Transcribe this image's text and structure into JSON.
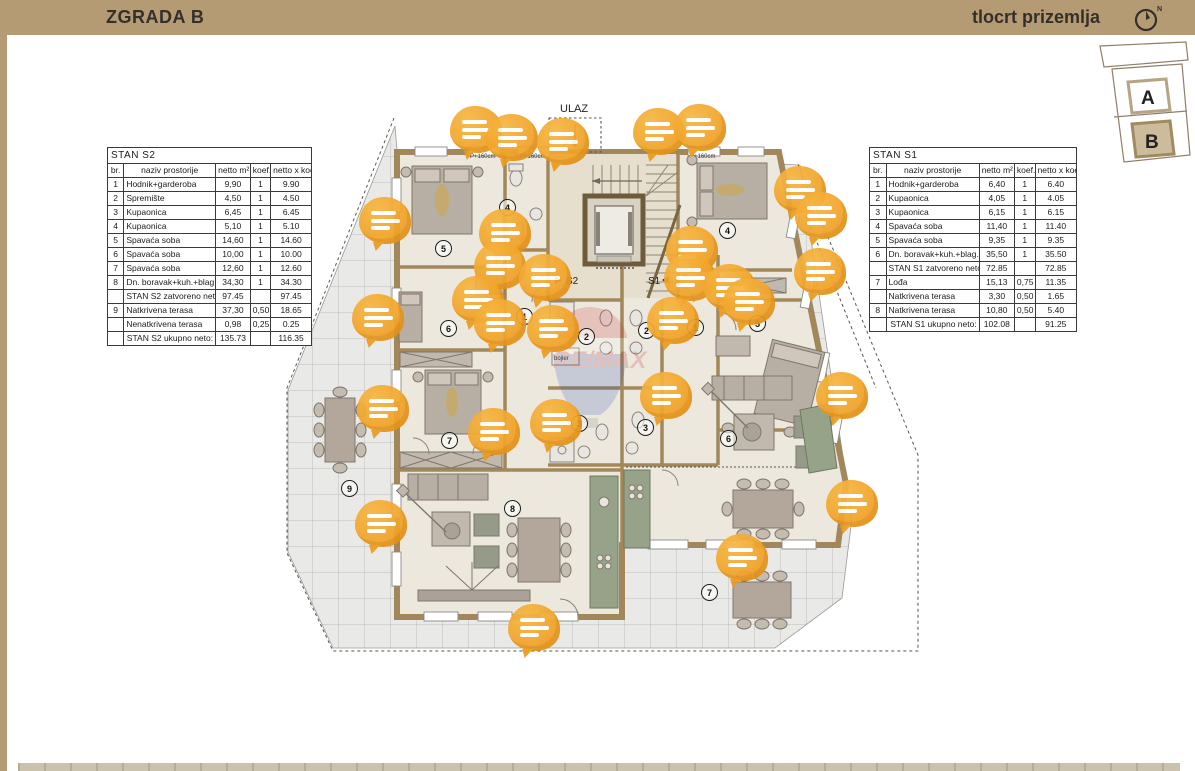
{
  "header": {
    "title_left": "ZGRADA B",
    "title_right": "tlocrt prizemlja",
    "north_label": "N",
    "bar_color": "#b59b74"
  },
  "site_diagram": {
    "building_a": "A",
    "building_b": "B"
  },
  "plan": {
    "entrance_label": "ULAZ",
    "door_label_left": "S2",
    "door_label_right": "S1",
    "boiler_label": "bojler",
    "watermark": "RE/MAX",
    "window_labels": [
      "P+160cm",
      "P+160cm",
      "P+160cm"
    ],
    "marker_color": "#f2a52b",
    "room_circles": [
      {
        "n": "5",
        "x": 443,
        "y": 248
      },
      {
        "n": "6",
        "x": 448,
        "y": 328
      },
      {
        "n": "7",
        "x": 449,
        "y": 440
      },
      {
        "n": "4",
        "x": 507,
        "y": 207
      },
      {
        "n": "1",
        "x": 524,
        "y": 316
      },
      {
        "n": "2",
        "x": 586,
        "y": 336
      },
      {
        "n": "3",
        "x": 579,
        "y": 423
      },
      {
        "n": "8",
        "x": 512,
        "y": 508
      },
      {
        "n": "9",
        "x": 349,
        "y": 488
      },
      {
        "n": "4",
        "x": 727,
        "y": 230
      },
      {
        "n": "5",
        "x": 757,
        "y": 323
      },
      {
        "n": "1",
        "x": 695,
        "y": 327
      },
      {
        "n": "2",
        "x": 646,
        "y": 330
      },
      {
        "n": "3",
        "x": 645,
        "y": 427
      },
      {
        "n": "6",
        "x": 728,
        "y": 438
      },
      {
        "n": "7",
        "x": 709,
        "y": 592
      }
    ],
    "markers": [
      {
        "x": 476,
        "y": 131
      },
      {
        "x": 512,
        "y": 139
      },
      {
        "x": 563,
        "y": 143
      },
      {
        "x": 659,
        "y": 133
      },
      {
        "x": 700,
        "y": 129
      },
      {
        "x": 800,
        "y": 191
      },
      {
        "x": 821,
        "y": 217
      },
      {
        "x": 385,
        "y": 222
      },
      {
        "x": 505,
        "y": 234
      },
      {
        "x": 500,
        "y": 267
      },
      {
        "x": 545,
        "y": 279
      },
      {
        "x": 478,
        "y": 301
      },
      {
        "x": 692,
        "y": 251
      },
      {
        "x": 690,
        "y": 279
      },
      {
        "x": 730,
        "y": 289
      },
      {
        "x": 749,
        "y": 303
      },
      {
        "x": 820,
        "y": 273
      },
      {
        "x": 378,
        "y": 319
      },
      {
        "x": 500,
        "y": 324
      },
      {
        "x": 553,
        "y": 330
      },
      {
        "x": 673,
        "y": 322
      },
      {
        "x": 383,
        "y": 410
      },
      {
        "x": 494,
        "y": 433
      },
      {
        "x": 556,
        "y": 424
      },
      {
        "x": 666,
        "y": 397
      },
      {
        "x": 842,
        "y": 397
      },
      {
        "x": 381,
        "y": 525
      },
      {
        "x": 852,
        "y": 505
      },
      {
        "x": 742,
        "y": 559
      },
      {
        "x": 534,
        "y": 629
      }
    ]
  },
  "tables": {
    "s2": {
      "title": "STAN S2",
      "columns": [
        "br.",
        "naziv prostorije",
        "netto m²",
        "koef.",
        "netto x koef. m²"
      ],
      "rows": [
        [
          "1",
          "Hodnik+garderoba",
          "9,90",
          "1",
          "9.90"
        ],
        [
          "2",
          "Spremište",
          "4,50",
          "1",
          "4.50"
        ],
        [
          "3",
          "Kupaonica",
          "6,45",
          "1",
          "6.45"
        ],
        [
          "4",
          "Kupaonica",
          "5,10",
          "1",
          "5.10"
        ],
        [
          "5",
          "Spavaća soba",
          "14,60",
          "1",
          "14.60"
        ],
        [
          "6",
          "Spavaća soba",
          "10,00",
          "1",
          "10.00"
        ],
        [
          "7",
          "Spavaća soba",
          "12,60",
          "1",
          "12.60"
        ],
        [
          "8",
          "Dn. boravak+kuh.+blag.",
          "34,30",
          "1",
          "34.30"
        ],
        [
          "",
          "STAN S2 zatvoreno neto:",
          "97.45",
          "",
          "97.45"
        ],
        [
          "9",
          "Natkrivena terasa",
          "37,30",
          "0,50",
          "18.65"
        ],
        [
          "",
          "Nenatkrivena terasa",
          "0,98",
          "0,25",
          "0.25"
        ],
        [
          "",
          "STAN S2 ukupno neto:",
          "135.73",
          "",
          "116.35"
        ]
      ]
    },
    "s1": {
      "title": "STAN S1",
      "columns": [
        "br.",
        "naziv prostorije",
        "netto m²",
        "koef.",
        "netto x koef. m²"
      ],
      "rows": [
        [
          "1",
          "Hodnik+garderoba",
          "6,40",
          "1",
          "6.40"
        ],
        [
          "2",
          "Kupaonica",
          "4,05",
          "1",
          "4.05"
        ],
        [
          "3",
          "Kupaonica",
          "6,15",
          "1",
          "6.15"
        ],
        [
          "4",
          "Spavaća soba",
          "11,40",
          "1",
          "11.40"
        ],
        [
          "5",
          "Spavaća soba",
          "9,35",
          "1",
          "9.35"
        ],
        [
          "6",
          "Dn. boravak+kuh.+blag.",
          "35,50",
          "1",
          "35.50"
        ],
        [
          "",
          "STAN S1 zatvoreno neto:",
          "72.85",
          "",
          "72.85"
        ],
        [
          "7",
          "Lođa",
          "15,13",
          "0,75",
          "11.35"
        ],
        [
          "",
          "Natkrivena terasa",
          "3,30",
          "0,50",
          "1.65"
        ],
        [
          "8",
          "Natkrivena terasa",
          "10,80",
          "0,50",
          "5.40"
        ],
        [
          "",
          "STAN S1 ukupno neto:",
          "102.08",
          "",
          "91.25"
        ]
      ]
    }
  }
}
